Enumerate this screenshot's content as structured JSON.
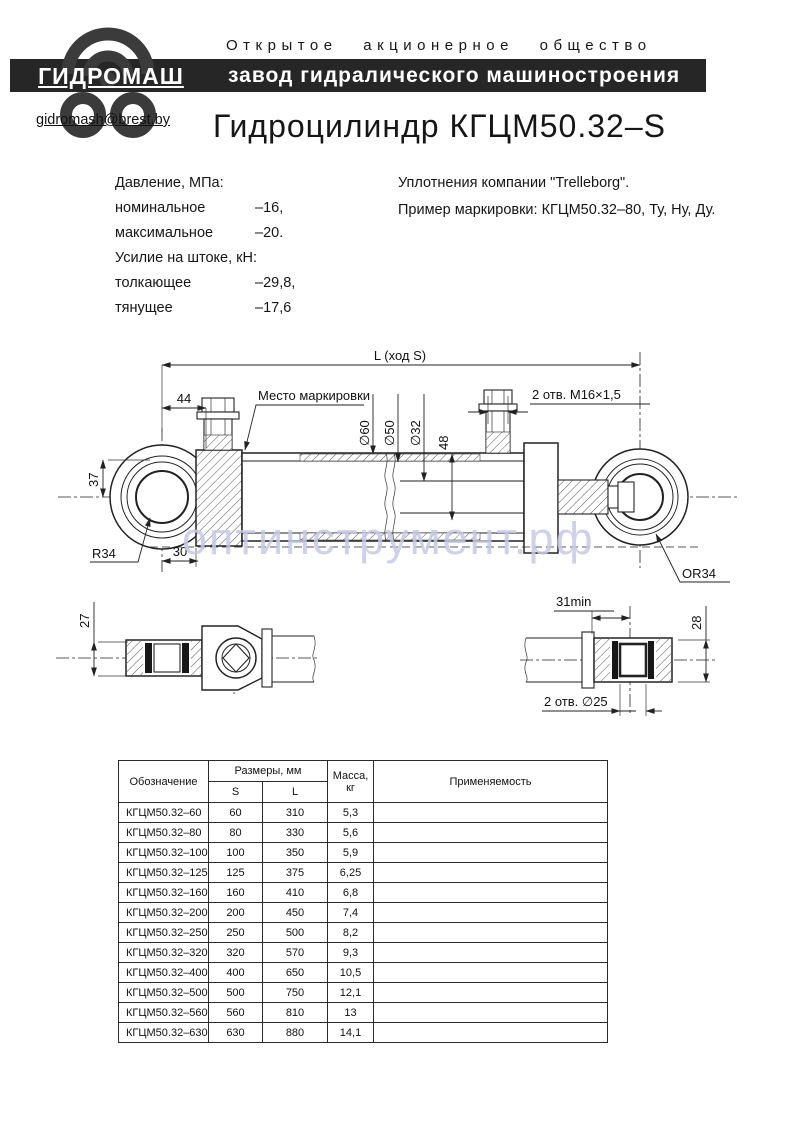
{
  "header": {
    "org_type": "Открытое акционерное общество",
    "org_name": "завод гидралического машиностроения",
    "logo": "ГИДРОМАШ",
    "email": "gidromash@brest.by"
  },
  "title": "Гидроцилиндр КГЦМ50.32–S",
  "specs": {
    "pressure_heading": "Давление, МПа:",
    "pressure_rows": [
      {
        "label": "номинальное",
        "value": "–16,"
      },
      {
        "label": "максимальное",
        "value": "–20."
      }
    ],
    "force_heading": "Усилие на штоке, кН:",
    "force_rows": [
      {
        "label": "толкающее",
        "value": "–29,8,"
      },
      {
        "label": "тянущее",
        "value": "–17,6"
      }
    ]
  },
  "notes": {
    "seals": "Уплотнения компании \"Trelleborg\".",
    "marking_example": "Пример маркировки: КГЦМ50.32–80, Ту, Ну, Ду."
  },
  "drawing": {
    "dims": {
      "overall": "L (ход S)",
      "d44": "44",
      "marking_place": "Место маркировки",
      "top_holes": "2 отв. М16×1,5",
      "dia60": "∅60",
      "dia50": "∅50",
      "dia32": "∅32",
      "d48": "48",
      "d37": "37",
      "d30": "30",
      "r34_left": "R34",
      "r34_right": "OR34",
      "d27": "27",
      "d31min": "31min",
      "d28": "28",
      "bottom_holes": "2 отв. ∅25"
    },
    "watermark": "оптинструмент.рф"
  },
  "table": {
    "headers": {
      "designation": "Обозначение",
      "sizes": "Размеры, мм",
      "s": "S",
      "l": "L",
      "mass_1": "Масса,",
      "mass_2": "кг",
      "application": "Применяемость"
    },
    "rows": [
      {
        "designation": "КГЦМ50.32–60",
        "s": "60",
        "l": "310",
        "mass": "5,3",
        "application": ""
      },
      {
        "designation": "КГЦМ50.32–80",
        "s": "80",
        "l": "330",
        "mass": "5,6",
        "application": ""
      },
      {
        "designation": "КГЦМ50.32–100",
        "s": "100",
        "l": "350",
        "mass": "5,9",
        "application": ""
      },
      {
        "designation": "КГЦМ50.32–125",
        "s": "125",
        "l": "375",
        "mass": "6,25",
        "application": ""
      },
      {
        "designation": "КГЦМ50.32–160",
        "s": "160",
        "l": "410",
        "mass": "6,8",
        "application": ""
      },
      {
        "designation": "КГЦМ50.32–200",
        "s": "200",
        "l": "450",
        "mass": "7,4",
        "application": ""
      },
      {
        "designation": "КГЦМ50.32–250",
        "s": "250",
        "l": "500",
        "mass": "8,2",
        "application": ""
      },
      {
        "designation": "КГЦМ50.32–320",
        "s": "320",
        "l": "570",
        "mass": "9,3",
        "application": ""
      },
      {
        "designation": "КГЦМ50.32–400",
        "s": "400",
        "l": "650",
        "mass": "10,5",
        "application": ""
      },
      {
        "designation": "КГЦМ50.32–500",
        "s": "500",
        "l": "750",
        "mass": "12,1",
        "application": ""
      },
      {
        "designation": "КГЦМ50.32–560",
        "s": "560",
        "l": "810",
        "mass": "13",
        "application": ""
      },
      {
        "designation": "КГЦМ50.32–630",
        "s": "630",
        "l": "880",
        "mass": "14,1",
        "application": ""
      }
    ]
  },
  "colors": {
    "bar": "#262626",
    "watermark": "#c6c9e6",
    "line": "#222222"
  }
}
